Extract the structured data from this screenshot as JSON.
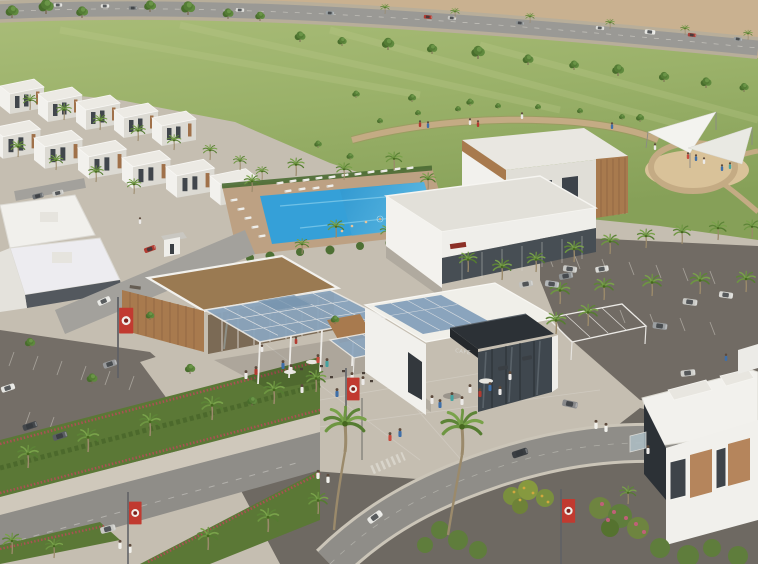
{
  "scene": {
    "type": "architectural-aerial-render",
    "description": "Aerial rendering of a residential community amenity plaza: clubhouse with solar canopy, CAFE pavilion, swimming pool with loungers, central park with shade sails, palm-lined parking and boulevards, white villas and townhouses, desert highway beyond",
    "cafe": {
      "sign": "CAFE"
    },
    "features": [
      "desert-highway",
      "park-lawn",
      "walking-path",
      "shade-sail-playground",
      "townhouse-rows",
      "swimming-pool",
      "sun-loungers",
      "clubhouse-solar-canopy",
      "cafe-building",
      "outdoor-seating-pergola",
      "parking-lots",
      "boulevard-medians",
      "street-banners",
      "villas",
      "palm-trees",
      "pedestrians",
      "cars"
    ],
    "colors": {
      "desert": "#c9b190",
      "asphalt": "#8f8d88",
      "lawn_green": "#8aa35c",
      "tree_green": "#547c35",
      "path_tan": "#c4ab84",
      "sand_playground": "#d9c299",
      "sail_white": "#f3f3ef",
      "building_white": "#f2f1ed",
      "wood_cladding": "#a87a4e",
      "solar_panel": "#8aa4bd",
      "cafe_fascia": "#2c3136",
      "pool_water": "#35a0d8",
      "pool_deck": "#bda183",
      "paver_dark": "#716b64",
      "plaza_pavers": "#c5beb1",
      "shrub_green": "#5b7836",
      "flower_red": "#b24d57",
      "banner_red": "#c13a30",
      "banner_emblem_dark": "#7e1f1a",
      "villa_wood": "#b5855c",
      "robe_white": "#eceae8"
    }
  }
}
